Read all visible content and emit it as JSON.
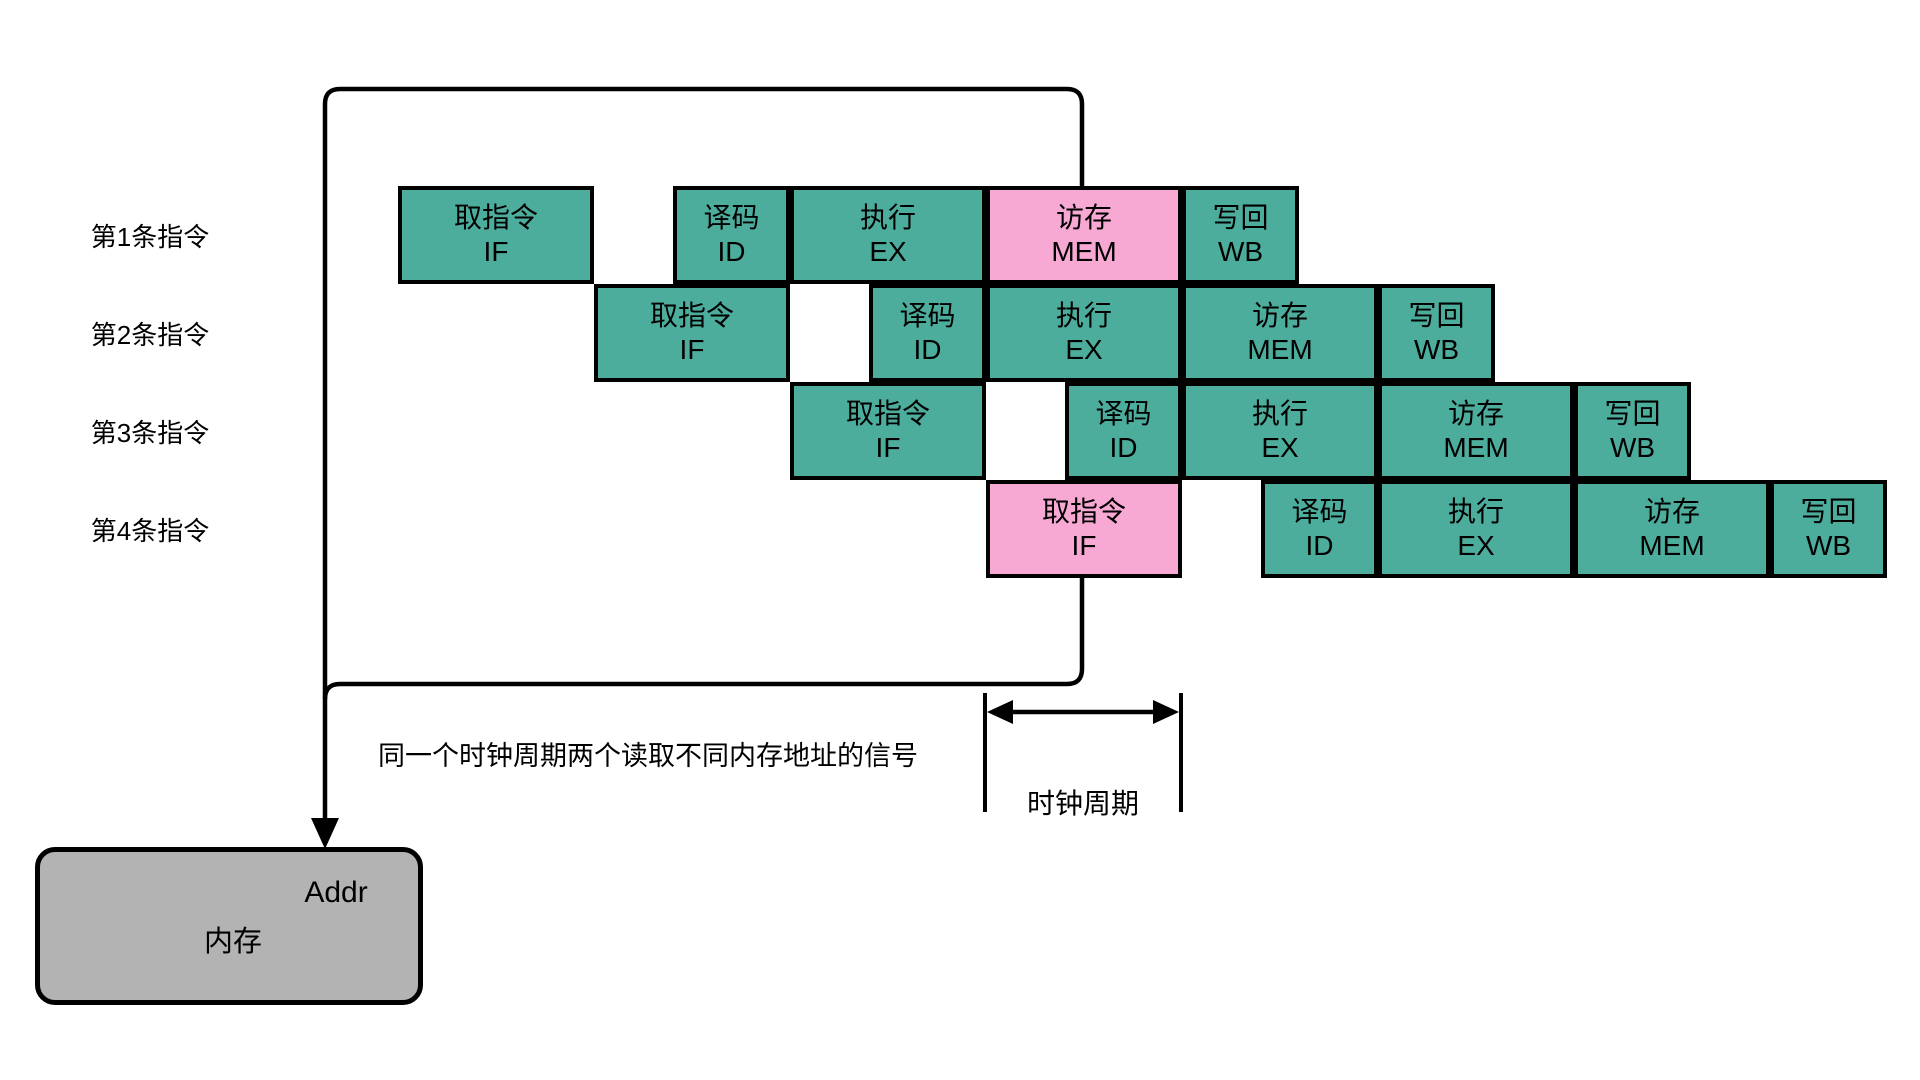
{
  "diagram": {
    "row_labels": [
      "第1条指令",
      "第2条指令",
      "第3条指令",
      "第4条指令"
    ],
    "stages": [
      {
        "id": "IF",
        "zh": "取指令",
        "en": "IF"
      },
      {
        "id": "ID",
        "zh": "译码",
        "en": "ID"
      },
      {
        "id": "EX",
        "zh": "执行",
        "en": "EX"
      },
      {
        "id": "MEM",
        "zh": "访存",
        "en": "MEM"
      },
      {
        "id": "WB",
        "zh": "写回",
        "en": "WB"
      }
    ],
    "highlighted": [
      {
        "row": 0,
        "stage": "MEM"
      },
      {
        "row": 3,
        "stage": "IF"
      }
    ],
    "annotation": "同一个时钟周期两个读取不同内存地址的信号",
    "clock_label": "时钟周期",
    "memory": {
      "label": "内存",
      "port_label": "Addr"
    },
    "colors": {
      "stage_fill": "#4DAD9D",
      "highlight_fill": "#F7A8D3",
      "memory_fill": "#B3B3B3",
      "line": "#000000"
    }
  }
}
